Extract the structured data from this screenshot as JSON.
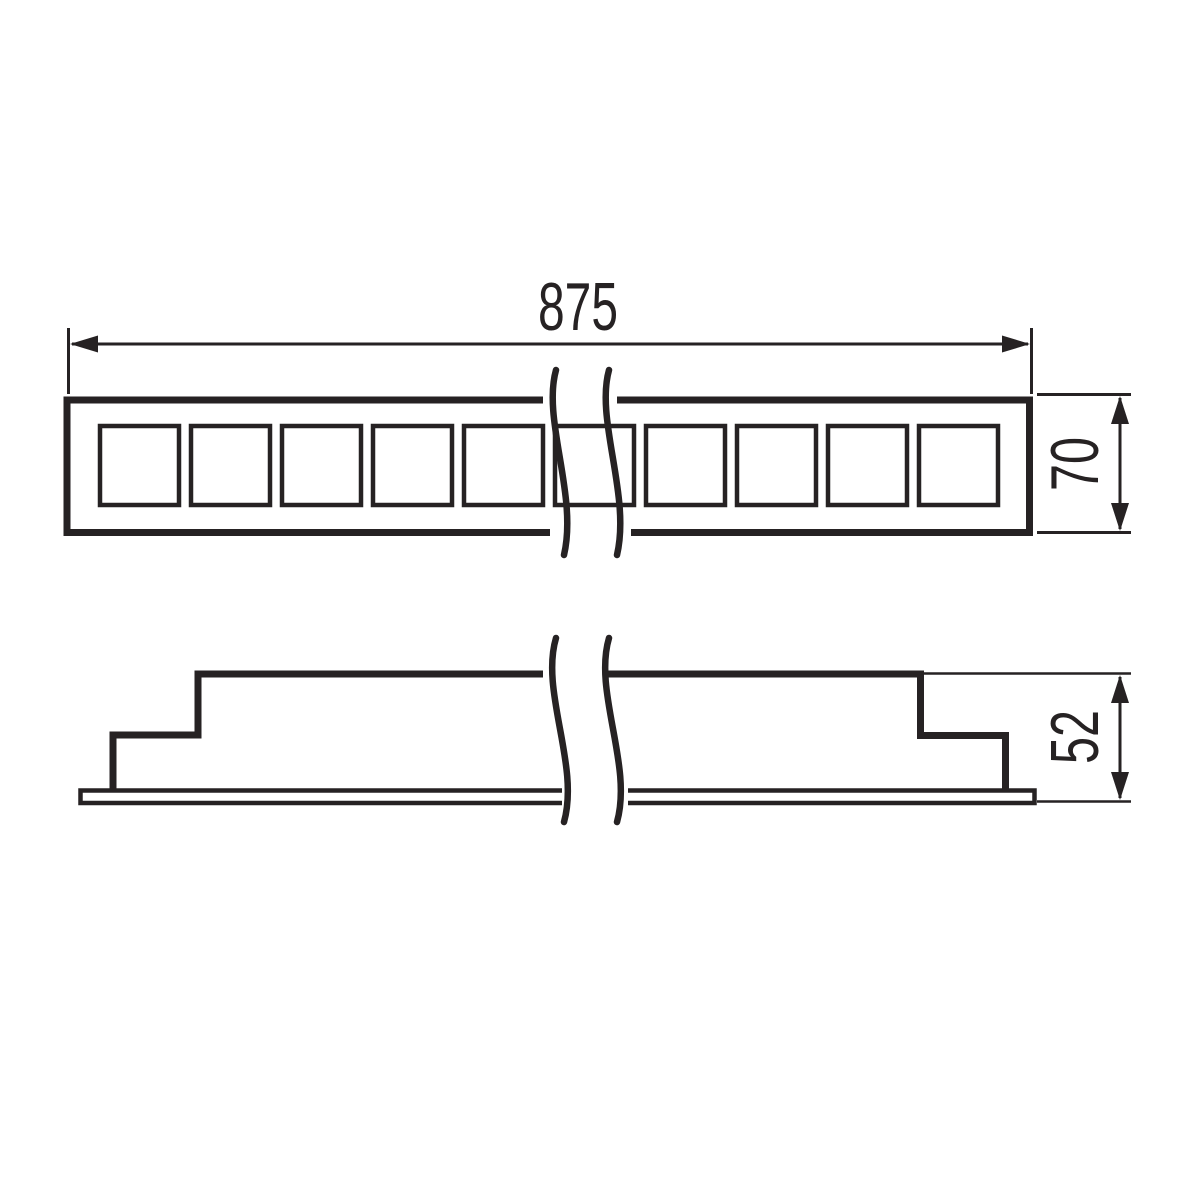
{
  "colors": {
    "line": "#262223",
    "ink": "#262223",
    "background": "#ffffff"
  },
  "front_view": {
    "width_label": "875",
    "height_label": "70",
    "cell_count": 10
  },
  "side_view": {
    "height_label": "52"
  }
}
